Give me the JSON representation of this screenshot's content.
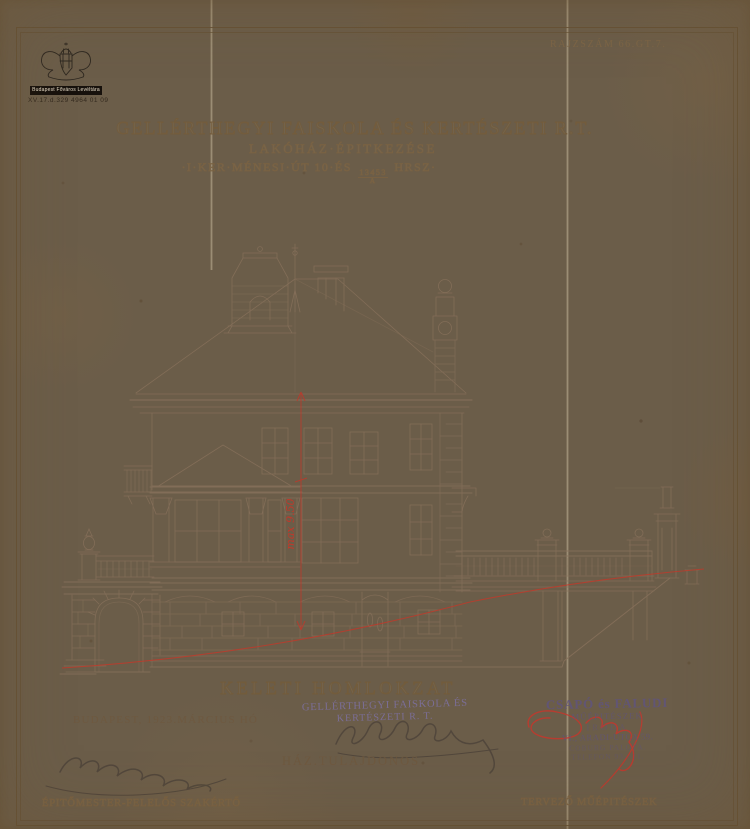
{
  "colors": {
    "paper": "#d8c49c",
    "pencil_line": "#86705a",
    "red_pencil": "#c0392b",
    "violet_ink": "#7d71a0",
    "graphite": "#4e443a"
  },
  "archive_stamp": {
    "institution": "Budapest Főváros Levéltára",
    "reference": "XV.17.d.329 4964 01 09"
  },
  "header": {
    "drawing_number": "RAJZSZÁM 66.GT.7."
  },
  "title": {
    "line1": "GELLÉRTHEGYI FAISKOLA ÉS KERTÉSZETI R.T.",
    "line2": "LAKÓHÁZ·ÉPITKEZÉSE",
    "line3_prefix": "·I·KER·MÉNESI·ÚT 10·ÉS",
    "lot_numerator": "13453",
    "lot_denominator": "A",
    "line3_suffix": "HRSZ·"
  },
  "drawing": {
    "caption": "KELETI HOMLOKZAT",
    "red_annotation": "max 9.50"
  },
  "footer": {
    "date_place": "BUDAPEST, 1923.MÁRCIUS HÓ",
    "left_role": "ÉPITŐMESTER-FELELŐS SZAKÉRTŐ",
    "owner_label": "HÁZ.TULAJDONOS",
    "owner_stamp_line1": "GELLÉRTHEGYI FAISKOLA ÉS",
    "owner_stamp_line2": "KERTÉSZETI R. T.",
    "architect_stamp_line1": "CSAPÓ és FALUDI",
    "architect_stamp_line2": "MŰÉPITÉSZEK",
    "architect_stamp_line3": "IRODA",
    "architect_stamp_line4": "VI., ARADI-UTCA 59.",
    "architect_stamp_line5": "COBURG PALOTA.",
    "architect_stamp_line6": "TELEFON 93—11.",
    "right_role": "TERVEZŐ MŰÉPITÉSZEK"
  }
}
